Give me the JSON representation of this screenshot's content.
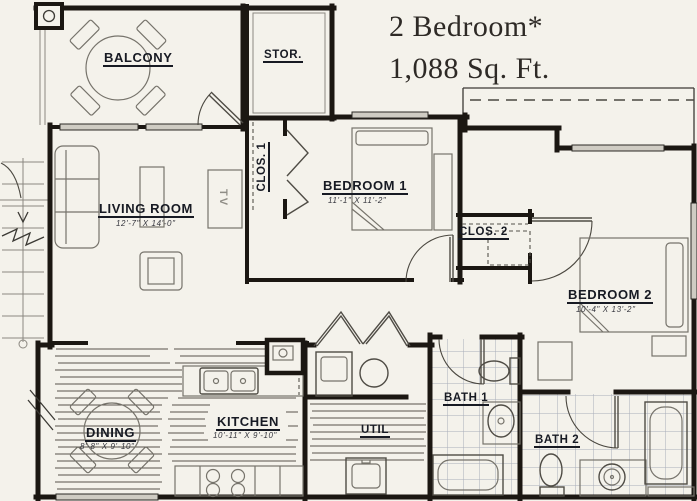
{
  "title": {
    "line1": "2 Bedroom*",
    "line2": "1,088 Sq. Ft."
  },
  "rooms": {
    "balcony": {
      "label": "BALCONY"
    },
    "storage": {
      "label": "STOR."
    },
    "living_room": {
      "label": "LIVING ROOM",
      "dims": "12'-7\" X 14'-0\""
    },
    "closet1": {
      "label": "CLOS. 1"
    },
    "bedroom1": {
      "label": "BEDROOM 1",
      "dims": "11'-1\" X 11'-2\""
    },
    "closet2": {
      "label": "CLOS. 2"
    },
    "bedroom2": {
      "label": "BEDROOM 2",
      "dims": "10'-4\" X 13'-2\""
    },
    "dining": {
      "label": "DINING",
      "dims": "8'-8\" X 9'-10\""
    },
    "kitchen": {
      "label": "KITCHEN",
      "dims": "10'-11\" X 9'-10\""
    },
    "util": {
      "label": "UTIL"
    },
    "bath1": {
      "label": "BATH 1"
    },
    "bath2": {
      "label": "BATH 2"
    }
  },
  "annotations": {
    "tv": "TV"
  },
  "colors": {
    "paper": "#f4f2eb",
    "wall": "#1b1712",
    "label": "#171a23",
    "tile": "#a9adb9"
  }
}
